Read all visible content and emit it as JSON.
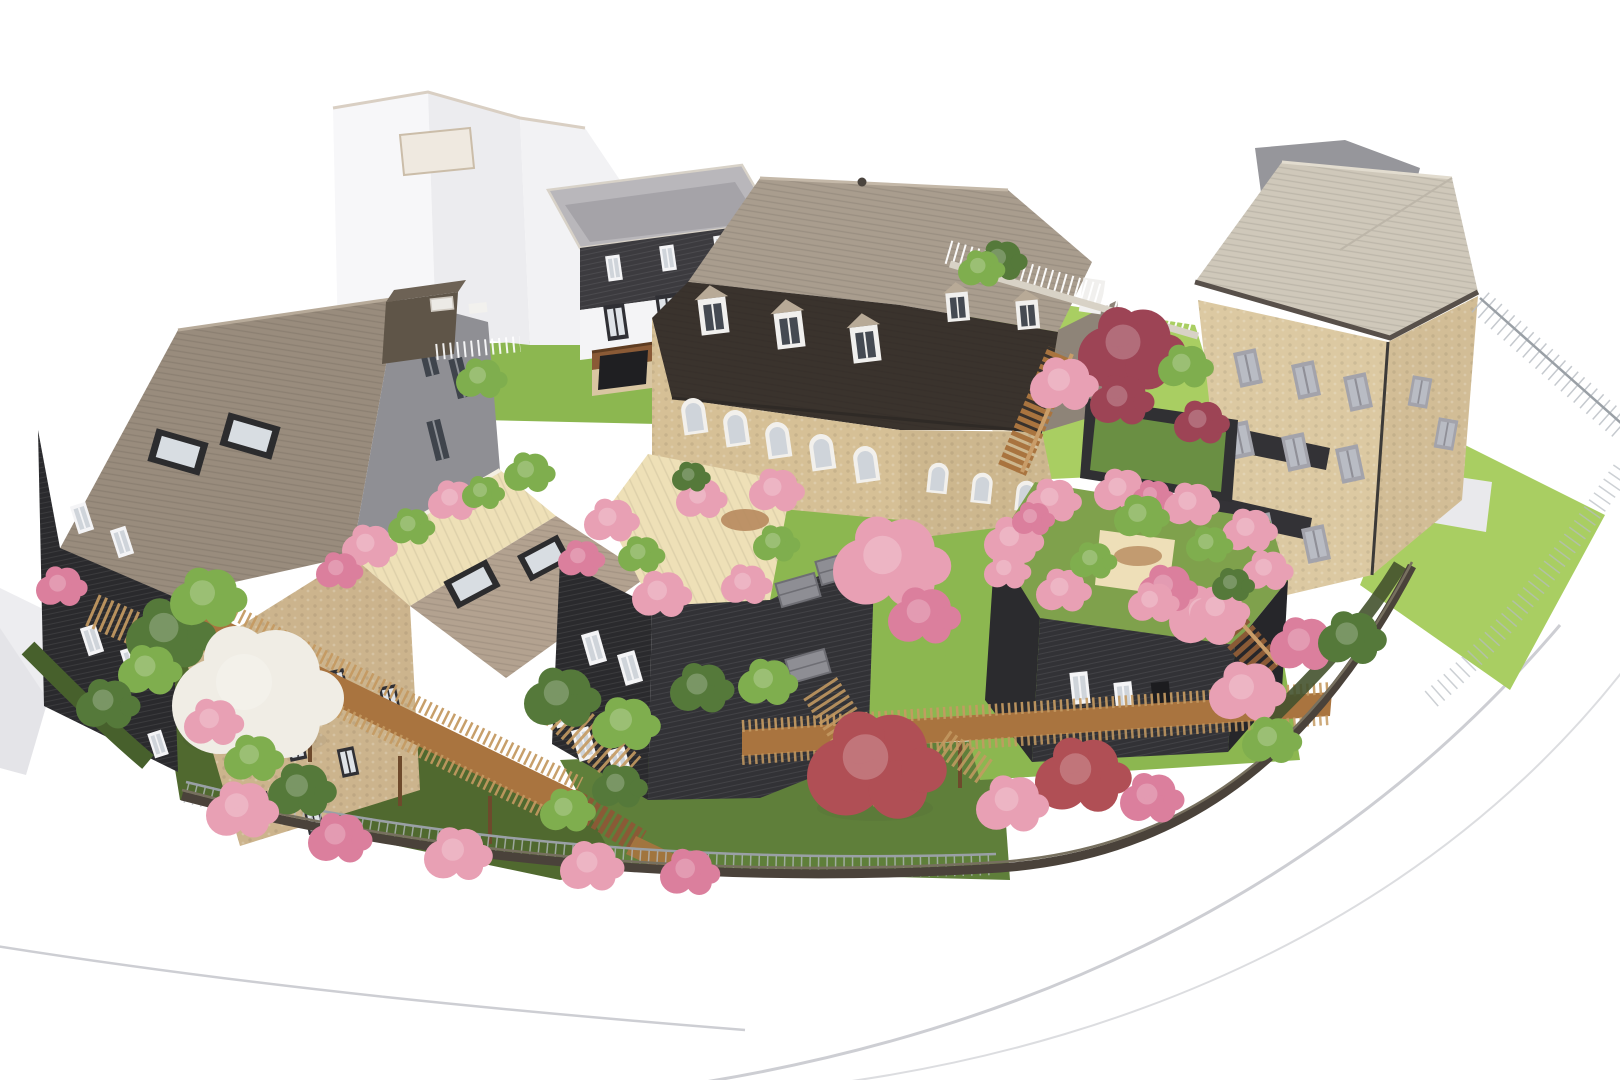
{
  "scene": {
    "type": "3d-architectural-rendering",
    "view": "aerial axonometric bird's-eye view",
    "setting": "residential infill development around communal landscaped gardens",
    "background": "plain white with faint curved street lines"
  },
  "palette": {
    "bg": "#ffffff",
    "roadLine": "#cdced3",
    "lawnBright": "#a9ce62",
    "lawnMid": "#8cb750",
    "lawnDark": "#5f7f3a",
    "underGrowth": "#50692f",
    "dirt": "#b78a5e",
    "deck": "#eee0b7",
    "bridgeWood": "#a9743f",
    "bridgeRail": "#c99d69",
    "fenceWood": "#c49a62",
    "stairWood": "#8a5a36",
    "stoneBeige": "#d6c096",
    "stoneBeigeLight": "#dcc9a2",
    "brick": "#ccb48d",
    "roofBrown": "#998c7d",
    "roofGreyTop": "#a99d8e",
    "roofPale": "#cfc8ba",
    "roofSlope": "#8f8f94",
    "mansardDark": "#3a332d",
    "darkClad": "#2a2a2d",
    "darkClad2": "#323236",
    "townhouseDark": "#3c3b3f",
    "contextWhite": "#f7f7f9",
    "contextShade": "#ececef",
    "flatRoof": "#b1afb4",
    "blossomPink": "#e8a0b4",
    "blossomPink2": "#db7f9d",
    "mapleRed": "#b04f55",
    "mapleRed2": "#9d4455",
    "shrubGreen": "#7fae4e",
    "shrubGreenDark": "#55793a",
    "blossomWhite": "#f0ede5",
    "wallDark": "#4a423a",
    "wireFence": "#b7bcc2",
    "chimney": "#5f5548",
    "glass": "#dfe3e8",
    "sedum": "#6a8f43"
  },
  "buildings": [
    {
      "id": "context-white-block",
      "desc": "untextured white gabled context building, top left"
    },
    {
      "id": "grey-townhouse",
      "desc": "flat-roof townhouse: dark timber attic storey over white floor, wood balcony, stone base"
    },
    {
      "id": "mansard-villa",
      "desc": "beige stone villa, pale hipped upper roof, dark steep mansard with white dormers, arched windows"
    },
    {
      "id": "dark-gable-house",
      "desc": "black timber-clad house, brown shingle roof, brown chimney box, roof windows in grey slope"
    },
    {
      "id": "brick-midrise",
      "desc": "light brick apartment block, set-back roof terrace with planters, shingled roof plane with skylights"
    },
    {
      "id": "black-cube",
      "desc": "black timber cube building, rooftop deck garden ringed by planters, balconies on right face"
    },
    {
      "id": "roof-garden-pavilion",
      "desc": "low black pavilion, densely planted pink roof garden, external wooden stair"
    },
    {
      "id": "stone-apartment",
      "desc": "tall beige stone apartment building, pale hip roof, grey windows, dark balcony bands, private lawn"
    }
  ],
  "landscape": {
    "features": [
      "bright communal lawns",
      "long wooden access ramp on stilts with slatted guardrails",
      "wooden footbridge linking buildings",
      "wooden stairs",
      "vertical-slat timber fences",
      "thin wire-mesh fences",
      "white fence on low wall",
      "dark stone retaining wall at street edge",
      "green sedum-roof garden box",
      "curved white street wrapping the site"
    ],
    "vegetation": [
      "pink blossom trees and shrubs",
      "white magnolia tree",
      "red japanese maples",
      "green shrubs and small trees",
      "rooftop planters"
    ]
  }
}
